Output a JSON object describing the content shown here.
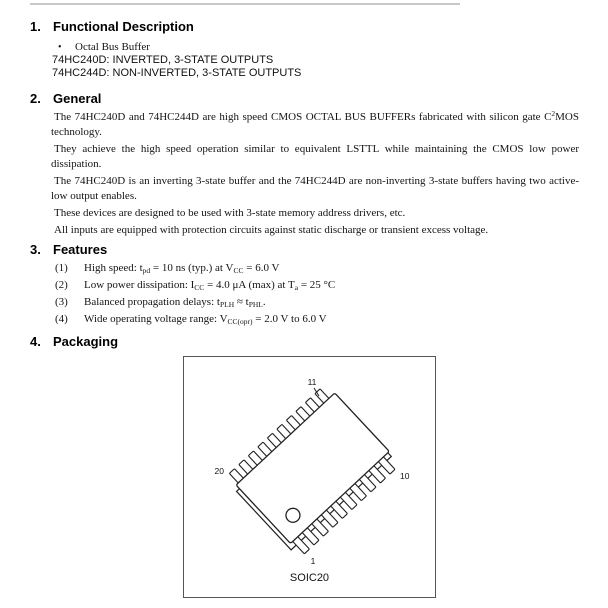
{
  "doc": {
    "s1": {
      "num": "1.",
      "title": "Functional Description",
      "bullet": "•",
      "bullet_text": "Octal Bus Buffer",
      "line1": "74HC240D: INVERTED, 3-STATE OUTPUTS",
      "line2": "74HC244D: NON-INVERTED, 3-STATE OUTPUTS"
    },
    "s2": {
      "num": "2.",
      "title": "General",
      "p1a": "The 74HC240D and 74HC244D are high speed CMOS OCTAL BUS BUFFERs fabricated with silicon gate C",
      "p1sup": "2",
      "p1b": "MOS technology.",
      "p2": "They achieve the high speed operation similar to equivalent LSTTL while maintaining the CMOS low power dissipation.",
      "p3": "The 74HC240D is an inverting 3-state buffer and the 74HC244D are non-inverting 3-state buffers having two active-low output enables.",
      "p4": "These devices are designed to be used with 3-state memory address drivers, etc.",
      "p5": "All inputs are equipped with protection circuits against static discharge or transient excess voltage."
    },
    "s3": {
      "num": "3.",
      "title": "Features",
      "f1": {
        "no": "(1)",
        "a": "High speed: t",
        "s1": "pd",
        "b": " = 10 ns (typ.) at V",
        "s2": "CC",
        "c": " = 6.0 V"
      },
      "f2": {
        "no": "(2)",
        "a": "Low power dissipation: I",
        "s1": "CC",
        "b": " = 4.0 μA (max) at T",
        "s2": "a",
        "c": " = 25 °C"
      },
      "f3": {
        "no": "(3)",
        "a": "Balanced propagation delays: t",
        "s1": "PLH",
        "b": " ≈ t",
        "s2": "PHL",
        "c": "."
      },
      "f4": {
        "no": "(4)",
        "a": "Wide operating voltage range: V",
        "s1": "CC(opr)",
        "b": " = 2.0 V to 6.0 V",
        "s2": "",
        "c": ""
      }
    },
    "s4": {
      "num": "4.",
      "title": "Packaging",
      "package_label": "SOIC20",
      "pins": {
        "top": "11",
        "left": "20",
        "right": "10",
        "bottom": "1"
      }
    }
  },
  "colors": {
    "rule": "#c9c9c9",
    "ink": "#1a1a1a",
    "outline": "#222222"
  }
}
